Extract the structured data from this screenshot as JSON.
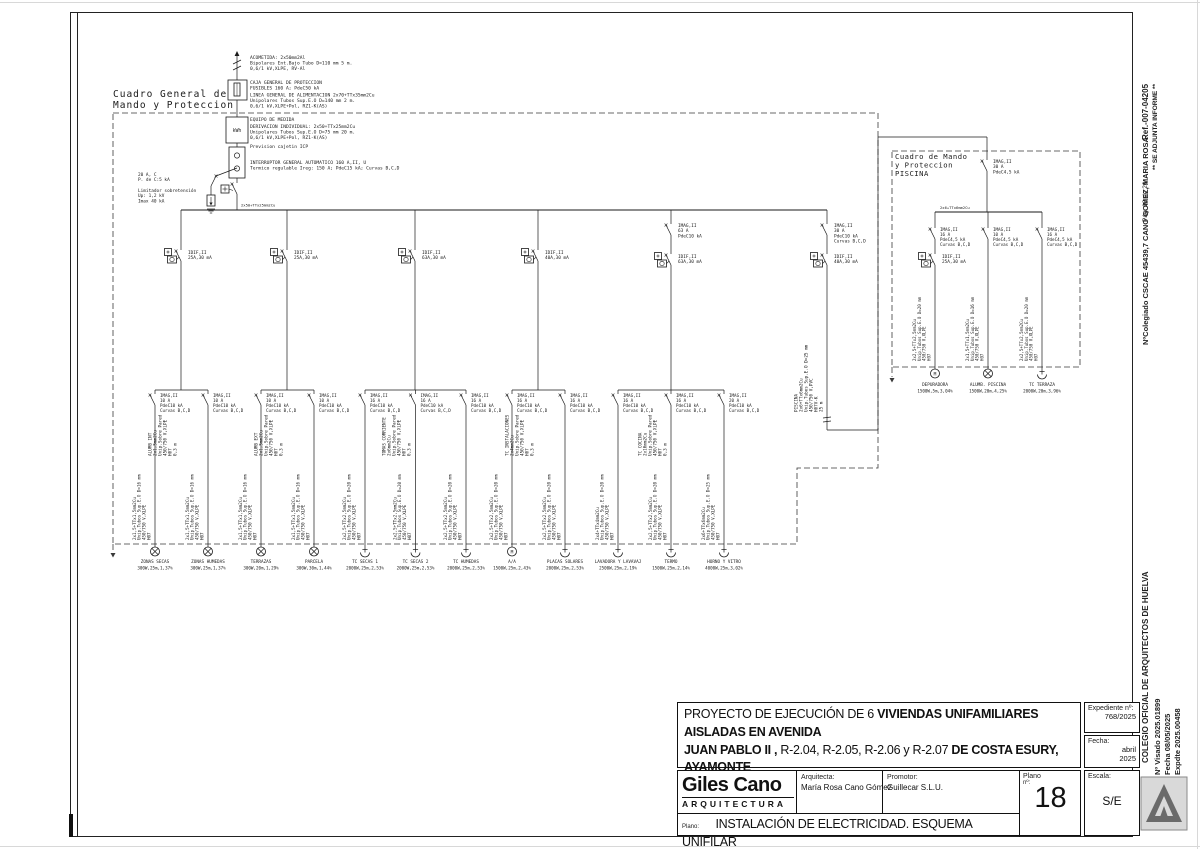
{
  "sheet": {
    "panel_main_label": [
      "Cuadro General de",
      "Mando y Proteccion"
    ],
    "meter_label": "kWh",
    "bus_label": "2x50+TTx25mm2Cu",
    "service_blocks": [
      {
        "lines": [
          "ACOMETIDA: 2x50mm2Al",
          "Bipolares Ent.Bajo Tubo D=110 mm 5 m.",
          "0,6/1 kV,XLPE, RV-Al"
        ]
      },
      {
        "lines": [
          "CAJA GENERAL DE PROTECCION",
          "FUSIBLES 160 A; PdeC50 kA"
        ]
      },
      {
        "lines": [
          "LINEA GENERAL DE ALIMENTACION 2x70+TTx35mm2Cu",
          "Unipolares  Tubos Sup.E.O D=140 mm 2 m.",
          "0,6/1 kV,XLPE+Pol, RZ1-K(AS)"
        ]
      },
      {
        "lines": [
          "EQUIPO DE MEDIDA"
        ]
      },
      {
        "lines": [
          "DERIVACION INDIVIDUAL: 2x50+TTx25mm2Cu",
          "Unipolares Tubos Sup.E.O D=75 mm 20 m.",
          "0,6/1 kV,XLPE+Pol, RZ1-K(AS)"
        ]
      },
      {
        "lines": [
          "Prevision cajetin ICP"
        ]
      },
      {
        "lines": [
          "INTERRUPTOR GENERAL AUTOMATICO 160 A,II, U",
          "Termico regulable Ireg: 150 A; PdeC15 kA; Curvas B,C,D"
        ]
      }
    ],
    "surge_block": {
      "breaker": [
        "20 A, C",
        "P. de C:5 kA"
      ],
      "limiter": [
        "Limitador sobretensión",
        "Up: 1,2 kV",
        "Imax 40 kA"
      ]
    },
    "branches": [
      {
        "diff": [
          "IDIF,II",
          "25A,30 mA"
        ],
        "cable": [
          "ALUMB INT",
          "2x1,5mm2Cu",
          "Unip.Sobre Pared",
          "450/750 V,XLPE",
          "H07",
          "0,3 m"
        ]
      },
      {
        "diff": [
          "IDIF,II",
          "25A,30 mA"
        ],
        "cable": [
          "ALUMB EXT",
          "2x1,5mm2Cu",
          "Unip.Sobre Pared",
          "450/750 V,XLPE",
          "H07",
          "0,3 m"
        ]
      },
      {
        "diff": [
          "IDIF,II",
          "63A,30 mA"
        ],
        "cable": [
          "TOMAS CORRIENTE",
          "2x6mm2Cu",
          "Unip.Sobre Pared",
          "450/750 V,XLPE",
          "H07",
          "0,3 m"
        ]
      },
      {
        "diff": [
          "IDIF,II",
          "40A,30 mA"
        ],
        "cable": [
          "TC INSTALACIONES",
          "2x4mm2Cu",
          "Unip.Sobre Pared",
          "450/750 V,XLPE",
          "H07",
          "0,3 m"
        ]
      },
      {
        "breaker": [
          "IMAG,II",
          "63 A",
          "PdeC10 kA"
        ],
        "diff": [
          "IDIF,II",
          "63A,30 mA"
        ],
        "cable": [
          "TC COCINA",
          "2x10mm2Cu",
          "Unip.Sobre Pared",
          "450/750 V,XLPE",
          "H07",
          "0,3 m"
        ]
      },
      {
        "breaker": [
          "IMAG,II",
          "30 A",
          "PdeC10 kA",
          "Curvas B,C,D"
        ],
        "diff": [
          "IDIF,II",
          "40A,30 mA"
        ],
        "cable": [
          "PISCINA",
          "2x6+TTx6mm2Cu",
          "Unip.Tubos Sup.E.O D=25 mm",
          "450/750 V,PVC",
          "H07V-K",
          "25 m"
        ]
      }
    ],
    "circuits": [
      {
        "breaker": [
          "IMAG,II",
          "10 A",
          "PdeC10 kA",
          "Curvas B,C,D"
        ],
        "cable": [
          "2x1,5+TTx1,5mm2Cu",
          "Unip.Tubos Sup.E.O D=16 mm",
          "450/750 V,XLPE",
          "H07"
        ],
        "load_type": "lamp",
        "load_name": "ZONAS SECAS",
        "load_value": "300W,25m,1,37%"
      },
      {
        "breaker": [
          "IMAG,II",
          "10 A",
          "PdeC10 kA",
          "Curvas B,C,D"
        ],
        "cable": [
          "2x1,5+TTx1,5mm2Cu",
          "Unip.Tubos Sup.E.O D=16 mm",
          "450/750 V,XLPE",
          "H07"
        ],
        "load_type": "lamp",
        "load_name": "ZONAS HUMEDAS",
        "load_value": "300W,25m,1,37%"
      },
      {
        "breaker": [
          "IMAG,II",
          "10 A",
          "PdeC10 kA",
          "Curvas B,C,D"
        ],
        "cable": [
          "2x1,5+TTx1,5mm2Cu",
          "Unip.Tubos Sup.E.O D=16 mm",
          "450/750 V,XLPE",
          "H07"
        ],
        "load_type": "lamp",
        "load_name": "TERRAZAS",
        "load_value": "300W,20m,1,29%"
      },
      {
        "breaker": [
          "IMAG,II",
          "10 A",
          "PdeC10 kA",
          "Curvas B,C,D"
        ],
        "cable": [
          "2x1,5+TTx1,5mm2Cu",
          "Unip.Tubos Sup.E.O D=16 mm",
          "450/750 V,XLPE",
          "H07"
        ],
        "load_type": "lamp",
        "load_name": "PARCELA",
        "load_value": "300W,30m,1,44%"
      },
      {
        "breaker": [
          "IMAG,II",
          "16 A",
          "PdeC10 kA",
          "Curvas B,C,D"
        ],
        "cable": [
          "2x2,5+TTx2,5mm2Cu",
          "Unip.Tubos Sup.E.O D=20 mm",
          "450/750 V,XLPE",
          "H07"
        ],
        "load_type": "socket",
        "load_name": "TC SECAS 1",
        "load_value": "2000W,25m,2,53%"
      },
      {
        "breaker": [
          "IMAG,II",
          "16 A",
          "PdeC10 kA",
          "Curvas B,C,D"
        ],
        "cable": [
          "2x2,5+TTx2,5mm2Cu",
          "Unip.Tubos Sup.E.O D=20 mm",
          "450/750 V,XLPE",
          "H07"
        ],
        "load_type": "socket",
        "load_name": "TC SECAS 2",
        "load_value": "2000W,25m,2,53%"
      },
      {
        "breaker": [
          "IMAG,II",
          "16 A",
          "PdeC10 kA",
          "Curvas B,C,D"
        ],
        "cable": [
          "2x2,5+TTx2,5mm2Cu",
          "Unip.Tubos Sup.E.O D=20 mm",
          "450/750 V,XLPE",
          "H07"
        ],
        "load_type": "socket",
        "load_name": "TC HUMEDAS",
        "load_value": "2000W,25m,2,53%"
      },
      {
        "breaker": [
          "IMAG,II",
          "16 A",
          "PdeC10 kA",
          "Curvas B,C,D"
        ],
        "cable": [
          "2x2,5+TTx2,5mm2Cu",
          "Unip.Tubos Sup.E.O D=20 mm",
          "450/750 V,XLPE",
          "H07"
        ],
        "load_type": "motor",
        "load_name": "A/A",
        "load_value": "1500W,25m,2,43%"
      },
      {
        "breaker": [
          "IMAG,II",
          "16 A",
          "PdeC10 kA",
          "Curvas B,C,D"
        ],
        "cable": [
          "2x2,5+TTx2,5mm2Cu",
          "Unip.Tubos Sup.E.O D=20 mm",
          "450/750 V,XLPE",
          "H07"
        ],
        "load_type": "socket",
        "load_name": "PLACAS SOLARES",
        "load_value": "2000W,25m,2,53%"
      },
      {
        "breaker": [
          "IMAG,II",
          "16 A",
          "PdeC10 kA",
          "Curvas B,C,D"
        ],
        "cable": [
          "2x4+TTx4mm2Cu",
          "Unip.Tubos Sup.E.O D=20 mm",
          "450/750 V,XLPE",
          "H07"
        ],
        "load_type": "socket",
        "load_name": "LAVADORA Y LAVAVAJ",
        "load_value": "2500W,25m,2,19%"
      },
      {
        "breaker": [
          "IMAG,II",
          "16 A",
          "PdeC10 kA",
          "Curvas B,C,D"
        ],
        "cable": [
          "2x2,5+TTx2,5mm2Cu",
          "Unip.Tubos Sup.E.O D=20 mm",
          "450/750 V,XLPE",
          "H07"
        ],
        "load_type": "socket",
        "load_name": "TERMO",
        "load_value": "1500W,25m,2,14%"
      },
      {
        "breaker": [
          "IMAG,II",
          "20 A",
          "PdeC10 kA",
          "Curvas B,C,D"
        ],
        "cable": [
          "2x6+TTx6mm2Cu",
          "Unip.Tubos Sup.E.O D=25 mm",
          "450/750 V,XLPE",
          "H07"
        ],
        "load_type": "socket",
        "load_name": "HORNO Y VITRO",
        "load_value": "4000W,25m,3,02%"
      }
    ],
    "piscina": {
      "panel_label": [
        "Cuadro de Mando",
        "y Proteccion",
        "PISCINA"
      ],
      "feed_breaker": [
        "IMAG,II",
        "30 A",
        "PdeC4,5 kA"
      ],
      "bus_label": "2x6+TTx6mm2Cu",
      "circuits": [
        {
          "breaker": [
            "IMAG,II",
            "16 A",
            "PdeC4,5 kA",
            "Curvas B,C,D"
          ],
          "diff": [
            "IDIF,II",
            "25A,30 mA"
          ],
          "cable": [
            "2x2,5+TTx2,5mm2Cu",
            "Unip.Tubos Sup.E.O D=20 mm",
            "450/750 V,XLPE",
            "H07"
          ],
          "load_type": "motor",
          "load_name": "DEPURADORA",
          "load_value": "1500W,5m,3,04%"
        },
        {
          "breaker": [
            "IMAG,II",
            "10 A",
            "PdeC4,5 kA",
            "Curvas B,C,D"
          ],
          "cable": [
            "2x1,5+TTx1,5mm2Cu",
            "Unip.Tubos Sup.E.O D=16 mm",
            "450/750 V,XLPE",
            "H07"
          ],
          "load_type": "lamp",
          "load_name": "ALUMB. PISCINA",
          "load_value": "1500W,20m,4,25%"
        },
        {
          "breaker": [
            "IMAG,II",
            "16 A",
            "PdeC4,5 kA",
            "Curvas B,C,D"
          ],
          "cable": [
            "2x2,5+TTx2,5mm2Cu",
            "Unip.Tubos Sup.E.O D=20 mm",
            "450/750 V,XLPE",
            "H07"
          ],
          "load_type": "socket",
          "load_name": "TC TERRAZA",
          "load_value": "2000W,20m,3,96%"
        }
      ]
    }
  },
  "title_block": {
    "project_lines": [
      [
        {
          "t": "PROYECTO DE EJECUCIÓN DE 6 ",
          "b": false
        },
        {
          "t": "VIVIENDAS UNIFAMILIARES  AISLADAS EN AVENIDA",
          "b": true
        }
      ],
      [
        {
          "t": "JUAN PABLO II ,",
          "b": true
        },
        {
          "t": "  R-2.04, R-2.05, R-2.06 y R-2.07  ",
          "b": false
        },
        {
          "t": "DE COSTA ESURY,  AYAMONTE",
          "b": true
        }
      ],
      [
        {
          "t": "(HUELVA)",
          "b": true
        }
      ]
    ],
    "expediente_label": "Expediente nº:",
    "expediente_value": "768/2025",
    "fecha_label": "Fecha:",
    "fecha_value_1": "abril",
    "fecha_value_2": "2025",
    "firm_name": "Giles Cano",
    "firm_sub": "ARQUITECTURA",
    "arquitecta_label": "Arquitecta:",
    "arquitecta_name": "María Rosa Cano Gómez",
    "promotor_label": "Promotor:",
    "promotor_name": "Guillecar  S.L.U.",
    "plano_label": "Plano",
    "plano_no_label": "nº:",
    "plano_number": "18",
    "escala_label": "Escala:",
    "escala_value": "S/E",
    "sheet_label": "Plano:",
    "sheet_title": "INSTALACIÓN DE ELECTRICIDAD. ESQUEMA UNIFILAR"
  },
  "margin": {
    "ref": "Ref.-007-04205",
    "informe": "** SE ADJUNTA INFORME **",
    "page": "Pág. 18 de 20",
    "colegiado": "NºColegiado CSCAE  45439,7  CANO GOMEZ, MARIA ROSA",
    "colegio": "COLEGIO OFICIAL DE ARQUITECTOS DE HUELVA",
    "visado": "Nº Visado  2025.01899",
    "visado_fecha": "Fecha   08/05/2025",
    "expdte": "Expdte    2025.00458"
  }
}
